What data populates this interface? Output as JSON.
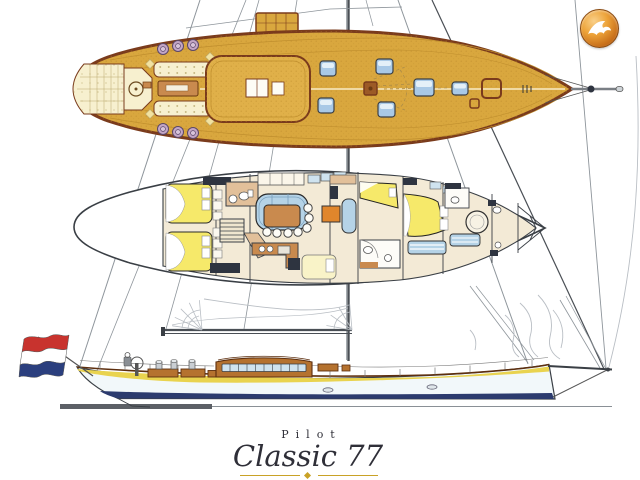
{
  "page": {
    "background": "#ffffff"
  },
  "badge": {
    "icon": "falcon-icon"
  },
  "title": {
    "series": "Pilot",
    "model": "Classic 77"
  },
  "views": {
    "top": "deck-plan",
    "middle": "accommodation-plan",
    "bottom": "sail-profile"
  },
  "flag": {
    "name": "netherlands-ensign",
    "bands": [
      "#c8332e",
      "#ffffff",
      "#2b3f7e"
    ]
  },
  "colors": {
    "paper": "#ffffff",
    "wood": "#d9a73e",
    "wood_light": "#e0b049",
    "wood_dark": "#7a3b1c",
    "cream": "#f7f0cf",
    "winch": "#c3a6c6",
    "hatch_blue": "#a9c9e6",
    "hatch_hi": "#e4f0f8",
    "line_gray": "#8e959b",
    "rig_dark": "#4a4f55",
    "floor": "#f3ead6",
    "tan": "#e2c09a",
    "counter": "#c98a4e",
    "bed_yellow": "#f6e96a",
    "settee_blue": "#b5d3e7",
    "dark_navy": "#2e3440",
    "pale_hull": "#f2f8fa",
    "stripe_yellow": "#e9d34f",
    "stripe_navy": "#2c3b6e",
    "house_brown": "#b5722f",
    "window_blue": "#cfe3ef",
    "gold": "#c9a227",
    "ink": "#2f2f38"
  }
}
